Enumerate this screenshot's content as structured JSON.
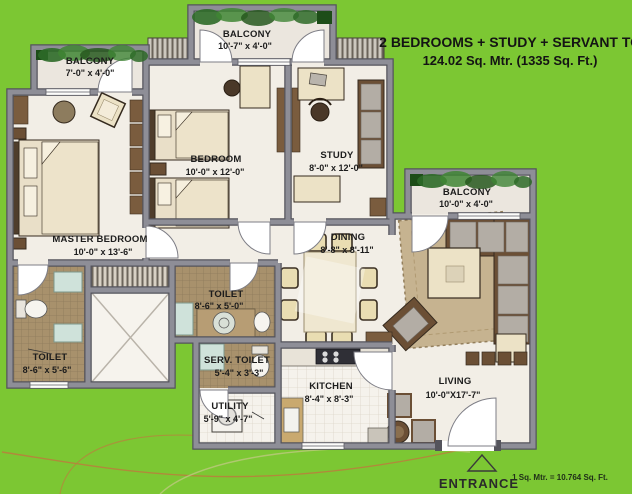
{
  "title": {
    "line1": "2 BEDROOMS + STUDY + SERVANT TOI.",
    "line2": "124.02 Sq. Mtr. (1335 Sq. Ft.)"
  },
  "rooms": [
    {
      "name": "BALCONY",
      "dims": "7'-0\" x 4'-0\""
    },
    {
      "name": "BALCONY",
      "dims": "10'-7\" x 4'-0\""
    },
    {
      "name": "BEDROOM",
      "dims": "10'-0\" x 12'-0\""
    },
    {
      "name": "STUDY",
      "dims": "8'-0\" x 12'-0\""
    },
    {
      "name": "MASTER BEDROOM",
      "dims": "10'-0\" x 13'-6\""
    },
    {
      "name": "DINING",
      "dims": "8'-8\" x 8'-11\""
    },
    {
      "name": "BALCONY",
      "dims": "10'-0\" x 4'-0\""
    },
    {
      "name": "TOILET",
      "dims": "8'-6\" x 5'-0\""
    },
    {
      "name": "TOILET",
      "dims": "8'-6\" x 5'-6\""
    },
    {
      "name": "SERV. TOILET",
      "dims": "5'-4\" x 3'-3\""
    },
    {
      "name": "UTILITY",
      "dims": "5'-9\" x 4'-7\""
    },
    {
      "name": "KITCHEN",
      "dims": "8'-4\" x 8'-3\""
    },
    {
      "name": "LIVING",
      "dims": "10'-0\"X17'-7\""
    }
  ],
  "footer": {
    "entrance_label": "ENTRANCE",
    "scale_note": "1 Sq. Mtr. = 10.764 Sq. Ft."
  },
  "colors": {
    "background": "#7cc733",
    "wall": "#8e8e97",
    "wall_edge": "#54545c",
    "floor": "#f2eee6",
    "toilet_tile": "#a8916c",
    "greenery": "#2e6a28"
  }
}
